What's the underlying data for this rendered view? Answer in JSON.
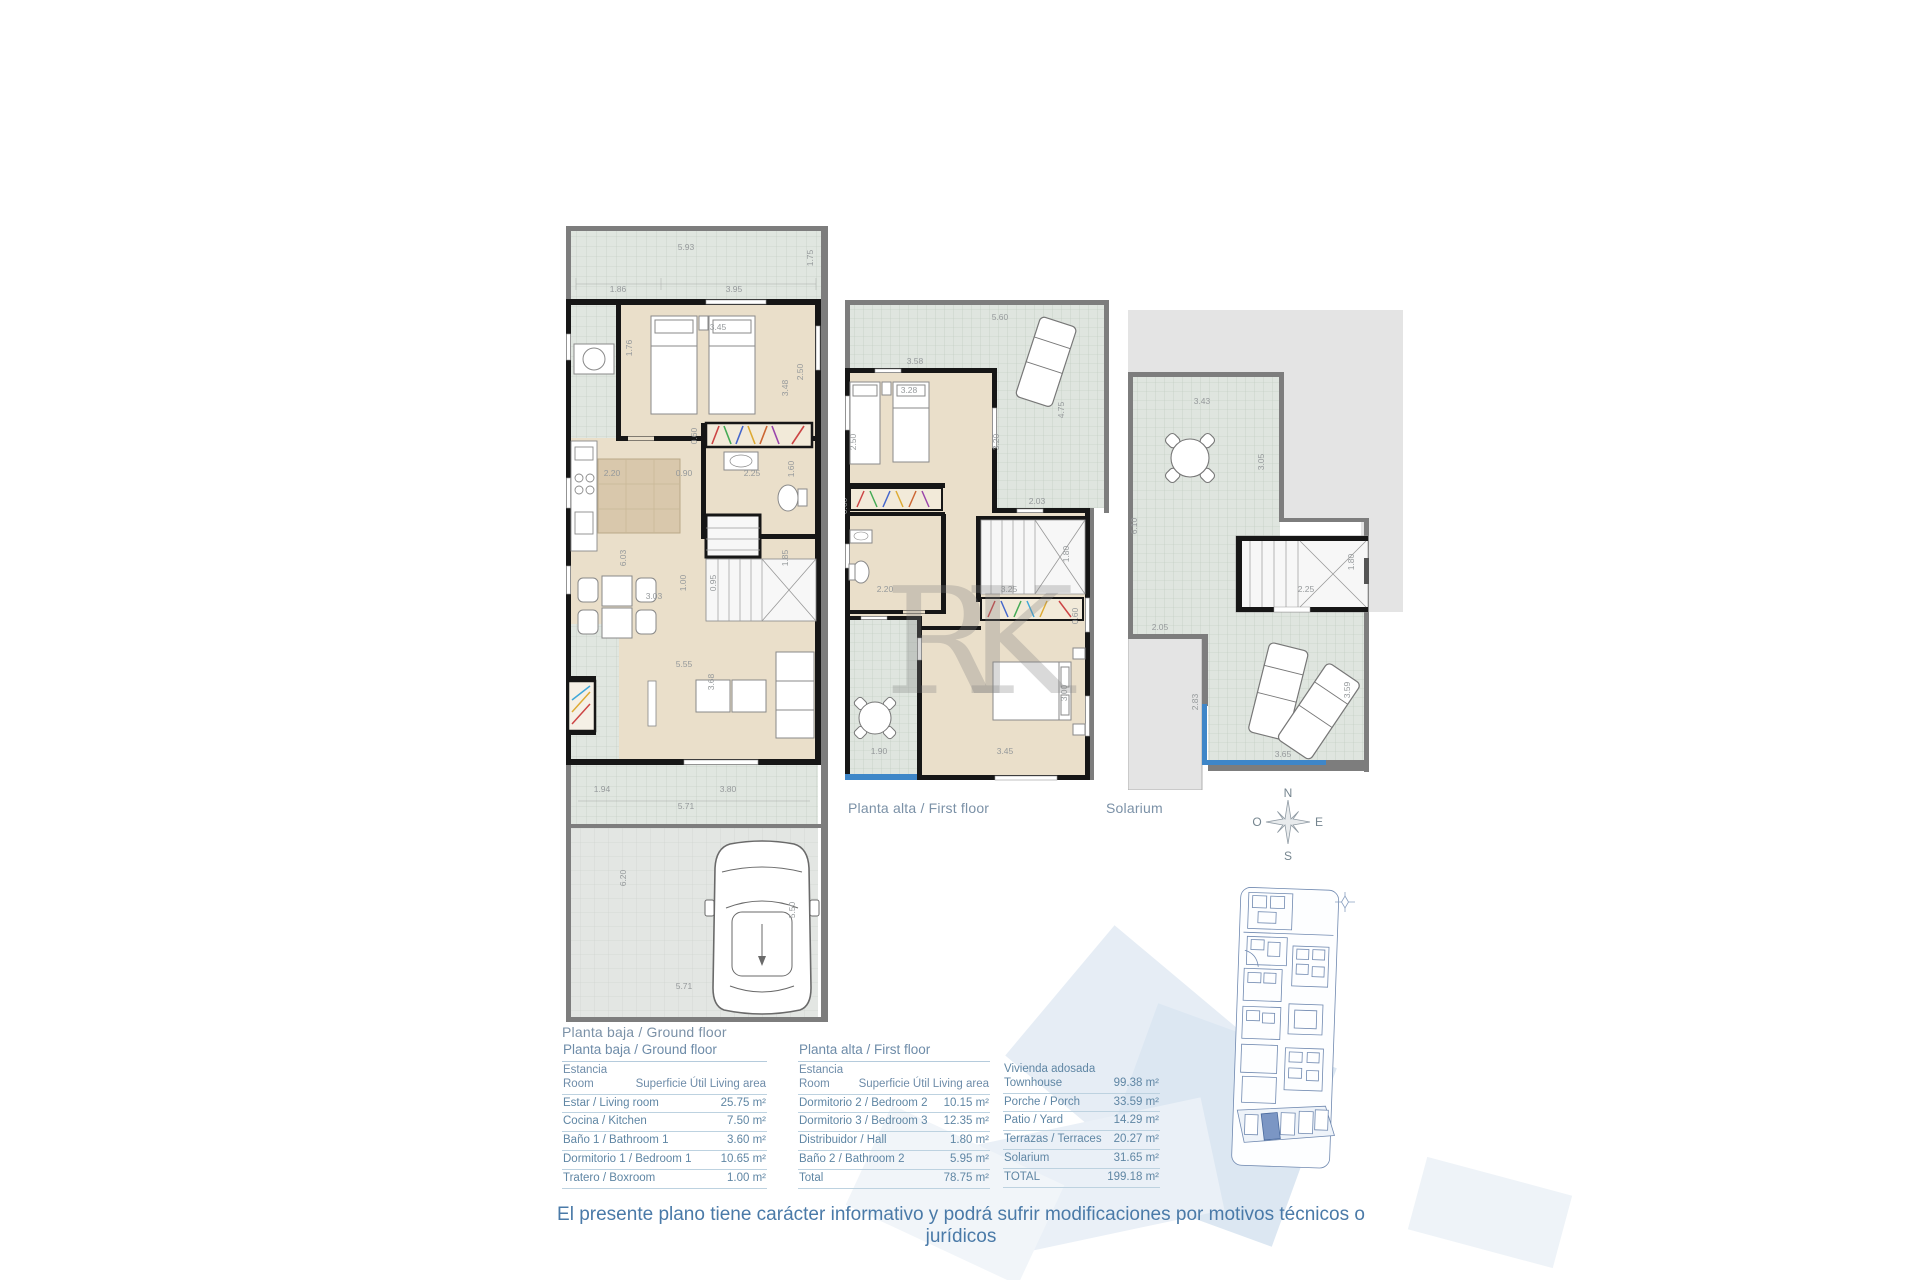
{
  "captions": {
    "ground": "Planta baja / Ground floor",
    "first": "Planta alta / First floor",
    "solarium": "Solarium"
  },
  "compass": {
    "north": "N",
    "south": "S",
    "east": "E",
    "west": "O"
  },
  "watermark_monogram": "RK",
  "disclaimer": "El presente plano tiene carácter informativo y podrá sufrir modificaciones por motivos técnicos o jurídicos",
  "plans": {
    "ground": {
      "dims": [
        {
          "t": "5.93",
          "x": 120,
          "y": 24,
          "r": 0
        },
        {
          "t": "1.75",
          "x": 247,
          "y": 32,
          "r": -90
        },
        {
          "t": "1.86",
          "x": 52,
          "y": 66,
          "r": 0
        },
        {
          "t": "3.95",
          "x": 168,
          "y": 66,
          "r": 0
        },
        {
          "t": "3.45",
          "x": 152,
          "y": 104,
          "r": 0
        },
        {
          "t": "2.50",
          "x": 237,
          "y": 146,
          "r": -90
        },
        {
          "t": "3.48",
          "x": 222,
          "y": 162,
          "r": -90
        },
        {
          "t": "1.76",
          "x": 66,
          "y": 122,
          "r": -90
        },
        {
          "t": "0.60",
          "x": 131,
          "y": 210,
          "r": -90
        },
        {
          "t": "2.20",
          "x": 46,
          "y": 250,
          "r": 0
        },
        {
          "t": "0.90",
          "x": 118,
          "y": 250,
          "r": 0
        },
        {
          "t": "2.25",
          "x": 186,
          "y": 250,
          "r": 0
        },
        {
          "t": "1.60",
          "x": 228,
          "y": 243,
          "r": -90
        },
        {
          "t": "6.03",
          "x": 60,
          "y": 332,
          "r": -90
        },
        {
          "t": "1.00",
          "x": 120,
          "y": 357,
          "r": -90
        },
        {
          "t": "0.95",
          "x": 150,
          "y": 357,
          "r": -90
        },
        {
          "t": "1.85",
          "x": 222,
          "y": 332,
          "r": -90
        },
        {
          "t": "3.03",
          "x": 88,
          "y": 373,
          "r": 0
        },
        {
          "t": "5.55",
          "x": 118,
          "y": 441,
          "r": 0
        },
        {
          "t": "3.68",
          "x": 148,
          "y": 456,
          "r": -90
        },
        {
          "t": "1.94",
          "x": 36,
          "y": 566,
          "r": 0
        },
        {
          "t": "3.80",
          "x": 162,
          "y": 566,
          "r": 0
        },
        {
          "t": "5.71",
          "x": 120,
          "y": 583,
          "r": 0
        },
        {
          "t": "6.20",
          "x": 60,
          "y": 652,
          "r": -90
        },
        {
          "t": "5.50",
          "x": 229,
          "y": 684,
          "r": -90
        },
        {
          "t": "5.71",
          "x": 118,
          "y": 763,
          "r": 0
        }
      ]
    },
    "first": {
      "dims": [
        {
          "t": "5.60",
          "x": 155,
          "y": 20,
          "r": 0
        },
        {
          "t": "3.58",
          "x": 70,
          "y": 64,
          "r": 0
        },
        {
          "t": "4.75",
          "x": 219,
          "y": 110,
          "r": -90
        },
        {
          "t": "3.28",
          "x": 64,
          "y": 93,
          "r": 0
        },
        {
          "t": "2.50",
          "x": 11,
          "y": 142,
          "r": -90
        },
        {
          "t": "3.20",
          "x": 154,
          "y": 142,
          "r": -90
        },
        {
          "t": "0.60",
          "x": 2,
          "y": 206,
          "r": -90
        },
        {
          "t": "2.03",
          "x": 192,
          "y": 204,
          "r": 0
        },
        {
          "t": "2.20",
          "x": 40,
          "y": 292,
          "r": 0
        },
        {
          "t": "3.25",
          "x": 164,
          "y": 292,
          "r": 0
        },
        {
          "t": "1.80",
          "x": 224,
          "y": 254,
          "r": -90
        },
        {
          "t": "0.60",
          "x": 233,
          "y": 316,
          "r": -90
        },
        {
          "t": "3.00",
          "x": 222,
          "y": 393,
          "r": -90
        },
        {
          "t": "1.90",
          "x": 34,
          "y": 454,
          "r": 0
        },
        {
          "t": "3.45",
          "x": 160,
          "y": 454,
          "r": 0
        }
      ]
    },
    "solarium": {
      "dims": [
        {
          "t": "3.43",
          "x": 74,
          "y": 94,
          "r": 0
        },
        {
          "t": "3.05",
          "x": 136,
          "y": 152,
          "r": -90
        },
        {
          "t": "6.10",
          "x": 9,
          "y": 216,
          "r": -90
        },
        {
          "t": "2.25",
          "x": 178,
          "y": 282,
          "r": 0
        },
        {
          "t": "1.80",
          "x": 226,
          "y": 252,
          "r": -90
        },
        {
          "t": "2.05",
          "x": 32,
          "y": 320,
          "r": 0
        },
        {
          "t": "2.83",
          "x": 70,
          "y": 392,
          "r": -90
        },
        {
          "t": "3.59",
          "x": 222,
          "y": 380,
          "r": -90
        },
        {
          "t": "3.65",
          "x": 155,
          "y": 447,
          "r": 0
        }
      ]
    }
  },
  "tables": [
    {
      "title": "Planta baja / Ground floor",
      "header": {
        "col1": "Estancia\nRoom",
        "col2": "Superficie Útil\nLiving area"
      },
      "rows": [
        {
          "label": "Estar / Living room",
          "value": "25.75 m²"
        },
        {
          "label": "Cocina / Kitchen",
          "value": "7.50 m²"
        },
        {
          "label": "Baño 1 / Bathroom 1",
          "value": "3.60 m²"
        },
        {
          "label": "Dormitorio 1 / Bedroom 1",
          "value": "10.65 m²"
        },
        {
          "label": "Tratero / Boxroom",
          "value": "1.00 m²"
        }
      ]
    },
    {
      "title": "Planta alta /  First floor",
      "header": {
        "col1": "Estancia\nRoom",
        "col2": "Superficie Útil\nLiving area"
      },
      "rows": [
        {
          "label": "Dormitorio 2 / Bedroom 2",
          "value": "10.15 m²"
        },
        {
          "label": "Dormitorio 3 / Bedroom 3",
          "value": "12.35 m²"
        },
        {
          "label": "Distribuidor / Hall",
          "value": "1.80 m²"
        },
        {
          "label": "Baño 2 / Bathroom 2",
          "value": "5.95 m²"
        },
        {
          "label": "Total",
          "value": "78.75 m²"
        }
      ]
    },
    {
      "title": "",
      "rows": [
        {
          "label": "Vivienda adosada\nTownhouse",
          "value": "99.38 m²"
        },
        {
          "label": "Porche / Porch",
          "value": "33.59 m²"
        },
        {
          "label": "Patio / Yard",
          "value": "14.29 m²"
        },
        {
          "label": "Terrazas / Terraces",
          "value": "20.27 m²"
        },
        {
          "label": "Solarium",
          "value": "31.65 m²"
        },
        {
          "label": "TOTAL",
          "value": "199.18 m²"
        }
      ]
    }
  ],
  "colors": {
    "interior": "#eadfca",
    "tile": "#e0e6e0",
    "wall_black": "#161616",
    "wall_gray": "#7d7d7d",
    "balustrade_blue": "#3e86c8",
    "table_text": "#5f86a4",
    "caption_text": "#7b91a7",
    "disclaimer_text": "#4a7aa8",
    "siteplan_line": "#7089b0",
    "siteplan_highlight": "#7b96c4"
  }
}
